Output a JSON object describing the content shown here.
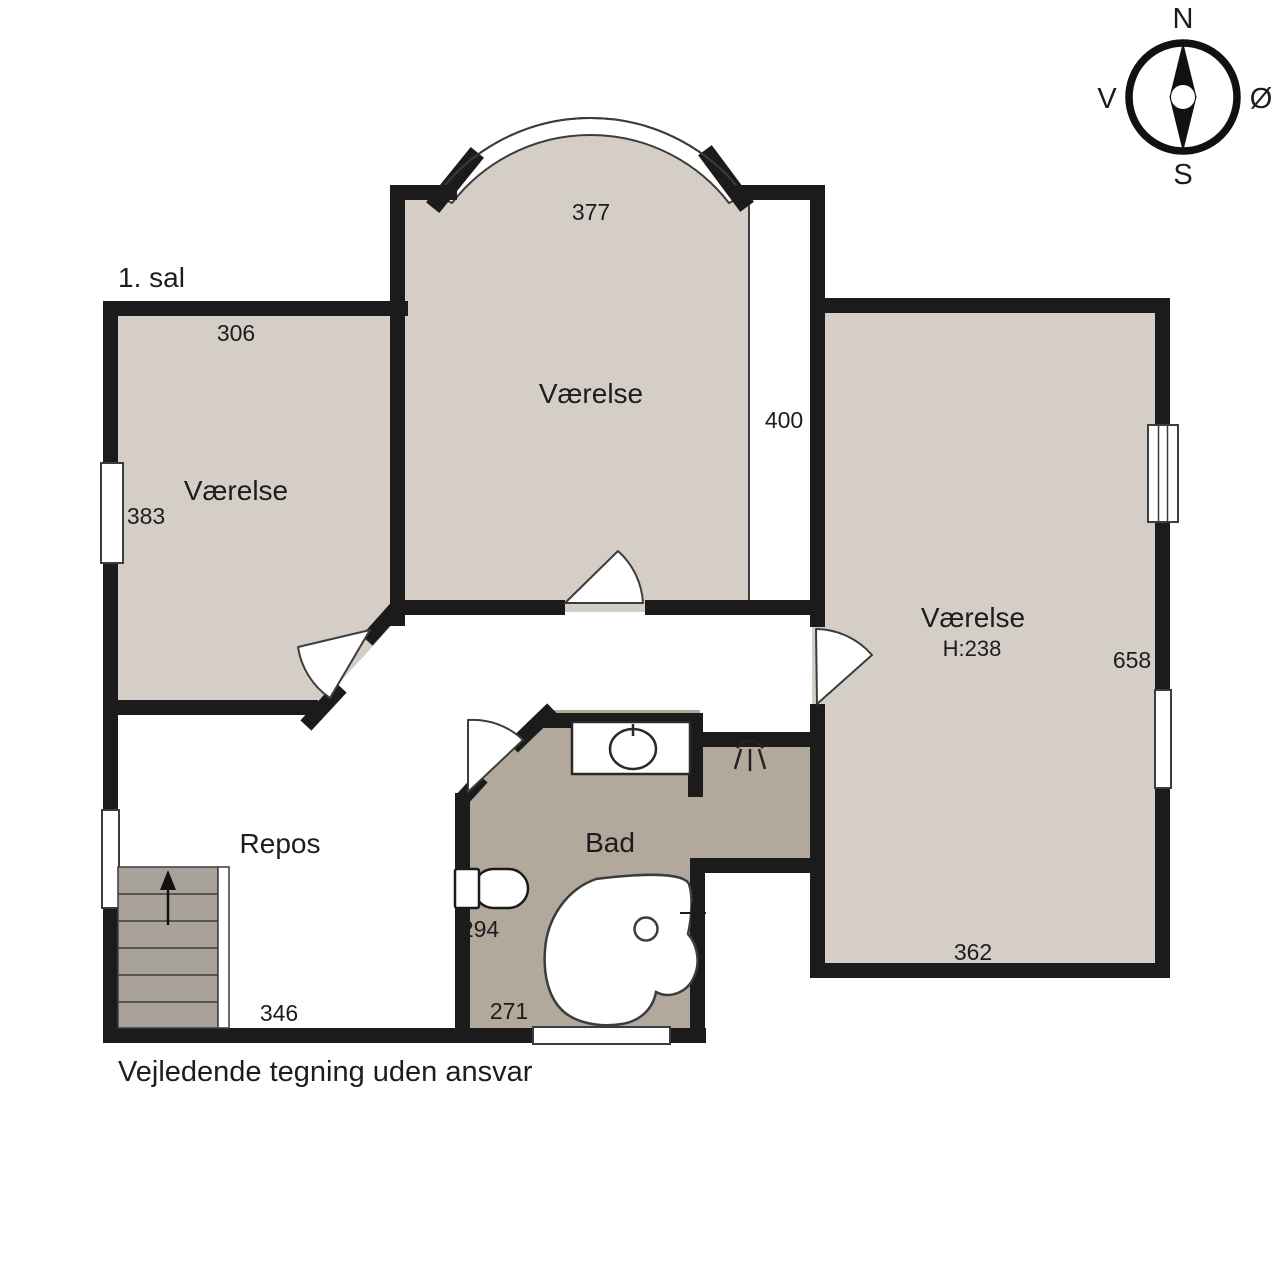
{
  "floor": {
    "title": "1. sal"
  },
  "disclaimer": "Vejledende tegning uden ansvar",
  "compass": {
    "north": "N",
    "south": "S",
    "west": "V",
    "east": "Ø"
  },
  "rooms": {
    "left": {
      "label": "Værelse",
      "width": "306",
      "depth": "383"
    },
    "top": {
      "label": "Værelse",
      "width": "377",
      "depth": "400"
    },
    "right": {
      "label": "Værelse",
      "ceiling": "H:238",
      "depth": "658",
      "width": "362"
    },
    "landing": {
      "label": "Repos",
      "width": "346"
    },
    "bath": {
      "label": "Bad",
      "dim_a": "294",
      "dim_b": "271"
    }
  },
  "colors": {
    "wall": "#1b1b1b",
    "room_fill": "#d4cec7",
    "bath_fill": "#b2a89b",
    "stairs_fill": "#a9a29a",
    "outline": "#3c3c3c"
  }
}
